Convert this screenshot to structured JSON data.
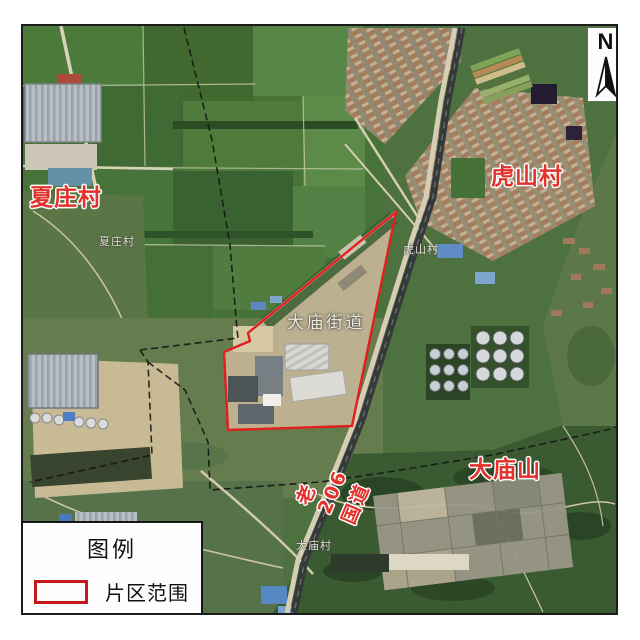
{
  "map": {
    "north_arrow": {
      "label": "N"
    },
    "place_labels": {
      "xiazhuang_village": "夏庄村",
      "hushan_village": "虎山村",
      "damiao_mountain": "大庙山",
      "damiao_subdistrict": "大庙街道",
      "old_206_national_road": "老206国道",
      "xiazhuang_village_small": "夏庄村",
      "hushan_village_small": "虎山村",
      "damiao_village_small": "大庙村"
    },
    "legend": {
      "title": "图例",
      "items": [
        {
          "label": "片区范围",
          "symbol": "red-outline-rectangle",
          "symbol_color": "#c6191e"
        }
      ]
    },
    "colors": {
      "district_boundary_red": "#e01f1f",
      "label_red": "#e3312b",
      "admin_boundary_black": "#141414",
      "railway_dark": "#35393a"
    }
  }
}
